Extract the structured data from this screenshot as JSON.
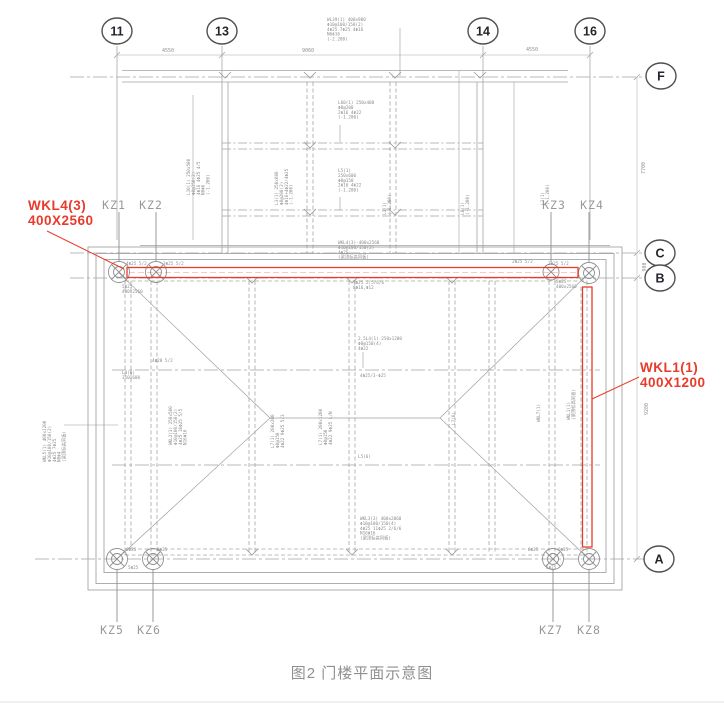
{
  "caption": "图2 门楼平面示意图",
  "colors": {
    "red": "#e83b2c",
    "line_gray": "#a6a6a6",
    "label_gray": "#8f8f8f"
  },
  "grid": {
    "number_bubbles": [
      {
        "label": "11",
        "x": 117,
        "y": 31
      },
      {
        "label": "13",
        "x": 222,
        "y": 31
      },
      {
        "label": "14",
        "x": 483,
        "y": 31
      },
      {
        "label": "16",
        "x": 590,
        "y": 31
      }
    ],
    "letter_bubbles": [
      {
        "label": "F",
        "x": 661,
        "y": 76
      },
      {
        "label": "C",
        "x": 660,
        "y": 253
      },
      {
        "label": "B",
        "x": 660,
        "y": 278
      },
      {
        "label": "A",
        "x": 659,
        "y": 559
      }
    ]
  },
  "dimensions": [
    {
      "text": "4550",
      "x": 168,
      "y": 52
    },
    {
      "text": "9060",
      "x": 308,
      "y": 52
    },
    {
      "text": "4550",
      "x": 532,
      "y": 51
    },
    {
      "text": "7700",
      "x": 645,
      "y": 168,
      "rot": -90
    },
    {
      "text": "900",
      "x": 646,
      "y": 267,
      "rot": -90
    },
    {
      "text": "9280",
      "x": 648,
      "y": 409,
      "rot": -90
    }
  ],
  "columns": [
    {
      "label": "KZ1",
      "x": 114,
      "y": 209
    },
    {
      "label": "KZ2",
      "x": 151,
      "y": 209
    },
    {
      "label": "KZ3",
      "x": 554,
      "y": 209
    },
    {
      "label": "KZ4",
      "x": 592,
      "y": 209
    },
    {
      "label": "KZ5",
      "x": 112,
      "y": 634
    },
    {
      "label": "KZ6",
      "x": 149,
      "y": 634
    },
    {
      "label": "KZ7",
      "x": 551,
      "y": 634
    },
    {
      "label": "KZ8",
      "x": 589,
      "y": 634
    }
  ],
  "red_labels": [
    {
      "x": 28,
      "y": 210,
      "lines": [
        "WKL4(3)",
        "400X2560"
      ]
    },
    {
      "x": 640,
      "y": 372,
      "lines": [
        "WKL1(1)",
        "400X1200"
      ]
    }
  ],
  "annotations": [
    {
      "x": 327,
      "y": 21,
      "lines": [
        "WL39(1) 400x900",
        "Φ10@100/150(2)",
        "4Φ25 7Φ25 4Φ16",
        "N6Φ16",
        "(-2.200)"
      ]
    },
    {
      "x": 338,
      "y": 104,
      "lines": [
        "L60(1) 250x400",
        "Φ8@200",
        "2Φ16 4Φ22",
        "(-1.200)"
      ]
    },
    {
      "x": 338,
      "y": 172,
      "lines": [
        "L5(1)",
        "250x600",
        "Φ8@150",
        "2Φ16 4Φ22",
        "(-1.200)"
      ]
    },
    {
      "x": 190,
      "y": 195,
      "rot": -90,
      "lines": [
        "L10(1) 250x500",
        "Φ8@150(2)",
        "4Φ16 4Φ25 4/5",
        "N8Φ6",
        "(-1.200)"
      ]
    },
    {
      "x": 278,
      "y": 205,
      "rot": -90,
      "lines": [
        "L3(1) 250x600",
        "Φ8@200(2)",
        "4Φ16+4Φ22/4Φ25",
        "(-1.200)"
      ]
    },
    {
      "x": 386,
      "y": 215,
      "rot": -90,
      "lines": [
        "L3(1)",
        "(-1.200)"
      ]
    },
    {
      "x": 464,
      "y": 215,
      "rot": -90,
      "lines": [
        "L8(1)",
        "(-1.200)"
      ]
    },
    {
      "x": 544,
      "y": 205,
      "rot": -90,
      "lines": [
        "L3(1)",
        "(-1.200)"
      ]
    },
    {
      "x": 338,
      "y": 244,
      "lines": [
        "WKL4(3)-400x2560",
        "Φ10@100/150(2)",
        "4Φ25",
        "(梁顶标高同板)"
      ]
    },
    {
      "x": 353,
      "y": 284,
      "lines": [
        "7Φ25 2/5/6/6",
        "8Φ16,Φ12"
      ]
    },
    {
      "x": 126,
      "y": 265,
      "lines": [
        "4Φ25 5/2"
      ]
    },
    {
      "x": 163,
      "y": 265,
      "lines": [
        "3Φ25 5/2"
      ]
    },
    {
      "x": 512,
      "y": 263,
      "lines": [
        "2Φ25 5/2"
      ]
    },
    {
      "x": 548,
      "y": 265,
      "lines": [
        "2Φ25 5/2"
      ]
    },
    {
      "x": 556,
      "y": 283,
      "lines": [
        "5Φ25",
        "400x2560"
      ]
    },
    {
      "x": 122,
      "y": 288,
      "lines": [
        "5Φ25",
        "400x2560"
      ]
    },
    {
      "x": 358,
      "y": 340,
      "lines": [
        "2.5L4(1) 250x1200",
        "Φ8@150(4)",
        "4Φ22"
      ]
    },
    {
      "x": 360,
      "y": 377,
      "lines": [
        "4Φ25/3-Φ25"
      ]
    },
    {
      "x": 172,
      "y": 445,
      "rot": -90,
      "lines": [
        "WKL2(3) 250x500",
        "Φ10@100/150(2)",
        "4Φ25 10Φ25 5/5",
        "N16Φ16"
      ]
    },
    {
      "x": 274,
      "y": 448,
      "rot": -90,
      "lines": [
        "L7(1) 200x200",
        "Φ8@150",
        "4Φ22 9Φ25 5/3"
      ]
    },
    {
      "x": 322,
      "y": 445,
      "rot": -90,
      "lines": [
        "L7(1) 200x1200",
        "Φ8@150",
        "4Φ22 9Φ25 L/N"
      ]
    },
    {
      "x": 358,
      "y": 458,
      "lines": [
        "L5(6)"
      ]
    },
    {
      "x": 152,
      "y": 362,
      "lines": [
        "4Φ20 5/2"
      ]
    },
    {
      "x": 122,
      "y": 374,
      "lines": [
        "L4(6)",
        "350x600"
      ]
    },
    {
      "x": 46,
      "y": 462,
      "rot": -90,
      "lines": [
        "WKL5(1) 400x1200",
        "Φ10@100/150(2)",
        "4Φ25 7Φ25",
        "N8Φ4",
        "(梁顶标高同板)"
      ]
    },
    {
      "x": 570,
      "y": 420,
      "rot": -90,
      "lines": [
        "WKL1(1)",
        "(梁顶标高同板)"
      ]
    },
    {
      "x": 540,
      "y": 422,
      "rot": -90,
      "lines": [
        "WKL7(1)"
      ]
    },
    {
      "x": 455,
      "y": 425,
      "rot": -90,
      "lines": [
        "L7(0)"
      ]
    },
    {
      "x": 360,
      "y": 520,
      "lines": [
        "WKL3(3) 400x2060",
        "Φ10@100/150(4)",
        "4Φ25 11Φ25 2/6/6",
        "N16Φ16",
        "(梁顶标高同板)"
      ]
    },
    {
      "x": 126,
      "y": 551,
      "lines": [
        "6Φ25"
      ]
    },
    {
      "x": 157,
      "y": 551,
      "lines": [
        "6Φ25"
      ]
    },
    {
      "x": 128,
      "y": 569,
      "lines": [
        "5Φ25"
      ]
    },
    {
      "x": 528,
      "y": 551,
      "lines": [
        "6Φ25"
      ]
    },
    {
      "x": 558,
      "y": 551,
      "lines": [
        "6Φ25"
      ]
    },
    {
      "x": 546,
      "y": 569,
      "lines": [
        "5Φ25"
      ]
    }
  ]
}
